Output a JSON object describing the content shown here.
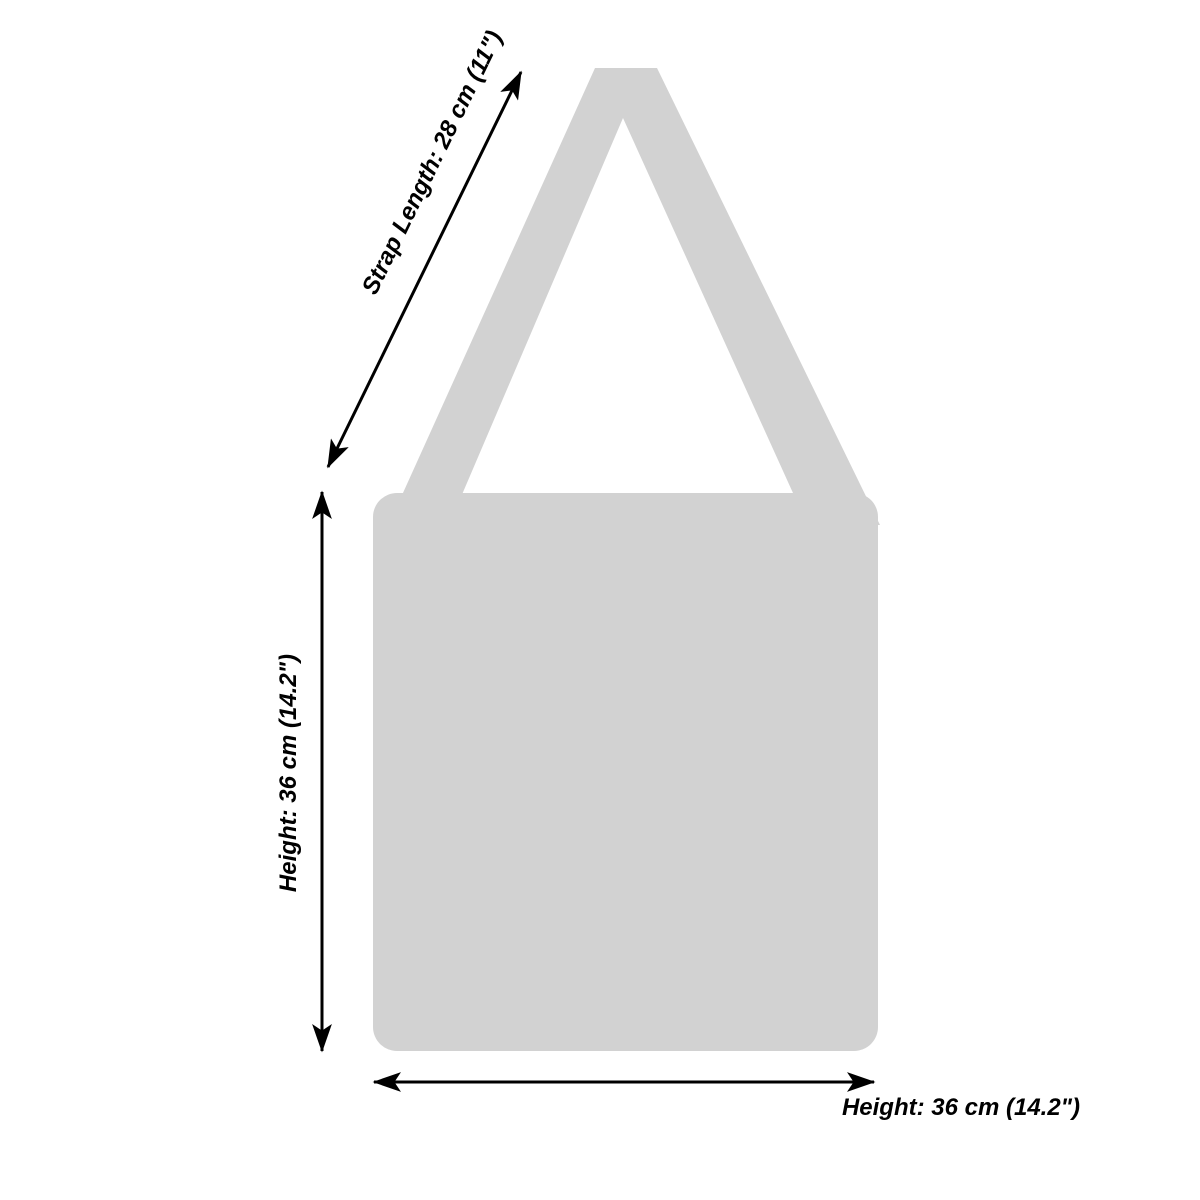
{
  "figure": {
    "silhouette_color": "#d2d2d2",
    "line_color": "#000000",
    "text_color": "#000000",
    "background_color": "#ffffff"
  },
  "dimensions": {
    "strap": {
      "label": "Strap Length: 28 cm (11\")",
      "value_cm": 28,
      "value_in": 11
    },
    "height_side": {
      "label": "Height: 36 cm (14.2\")",
      "value_cm": 36,
      "value_in": 14.2
    },
    "height_bottom": {
      "label": "Height: 36 cm (14.2\")",
      "value_cm": 36,
      "value_in": 14.2
    }
  }
}
